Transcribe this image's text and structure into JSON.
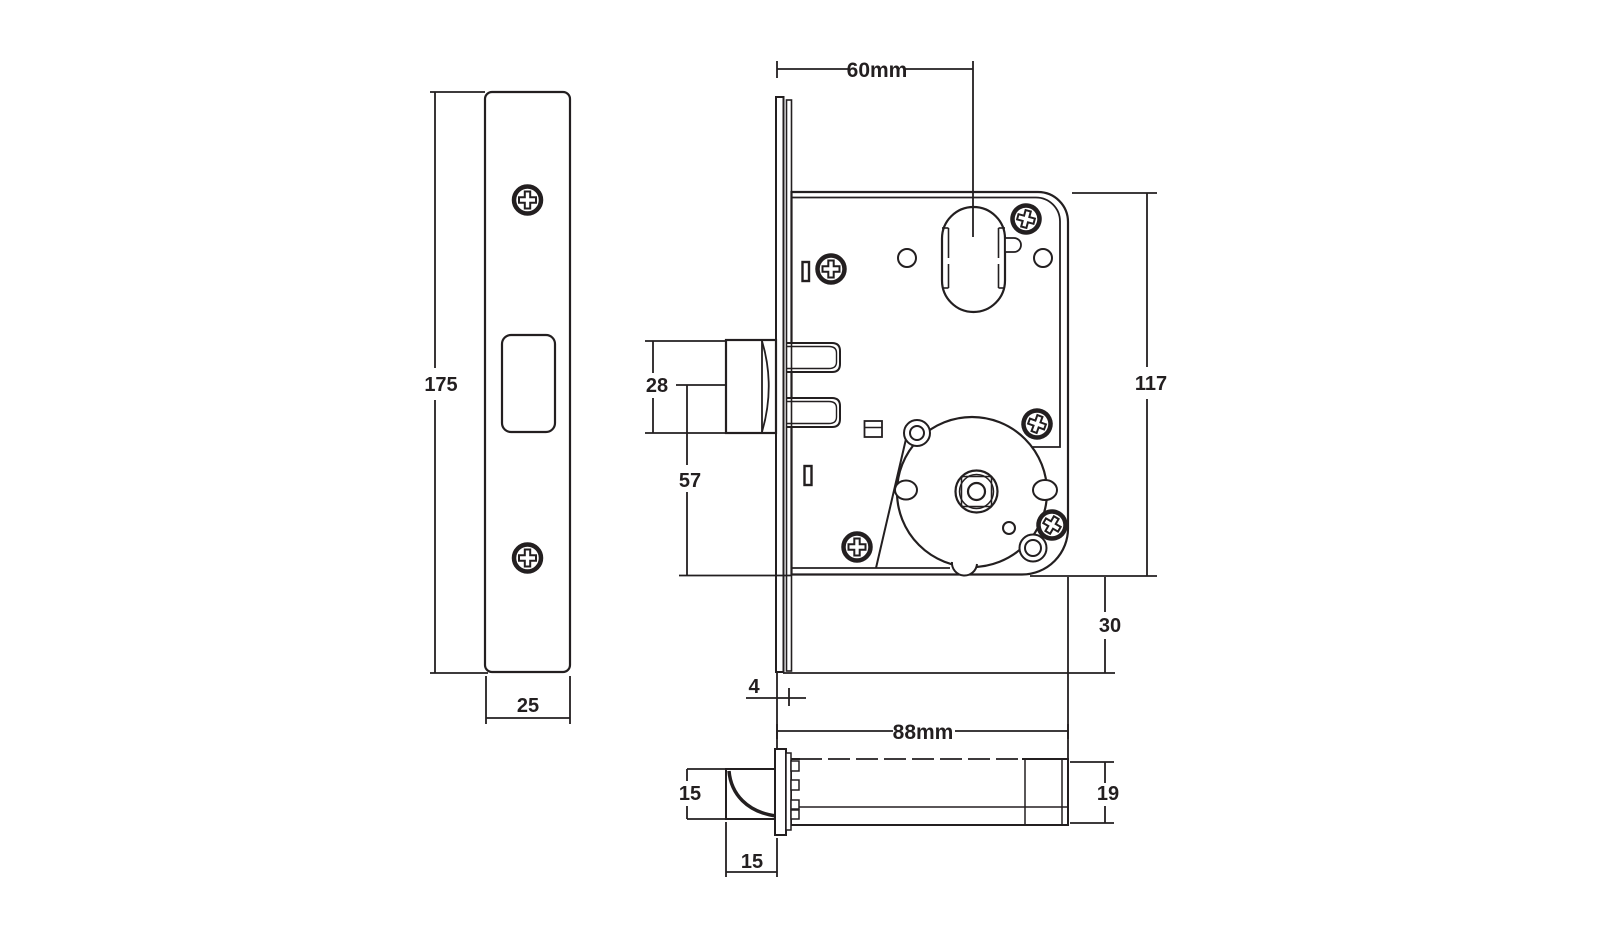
{
  "drawing": {
    "background_color": "#ffffff",
    "line_color": "#231f20",
    "views": {
      "faceplate_front": {
        "label": "faceplate front view"
      },
      "body_side": {
        "label": "lock case side view"
      },
      "top": {
        "label": "lock top view"
      }
    },
    "dimensions": {
      "faceplate_height": "175",
      "faceplate_width": "25",
      "backset": "60mm",
      "deadbolt_height": "28",
      "deadbolt_center_to_case_bottom": "57",
      "case_height": "117",
      "faceplate_below_case": "30",
      "faceplate_thickness": "4",
      "case_depth": "88mm",
      "latch_height": "15",
      "latch_depth": "15",
      "case_thickness": "19"
    }
  }
}
